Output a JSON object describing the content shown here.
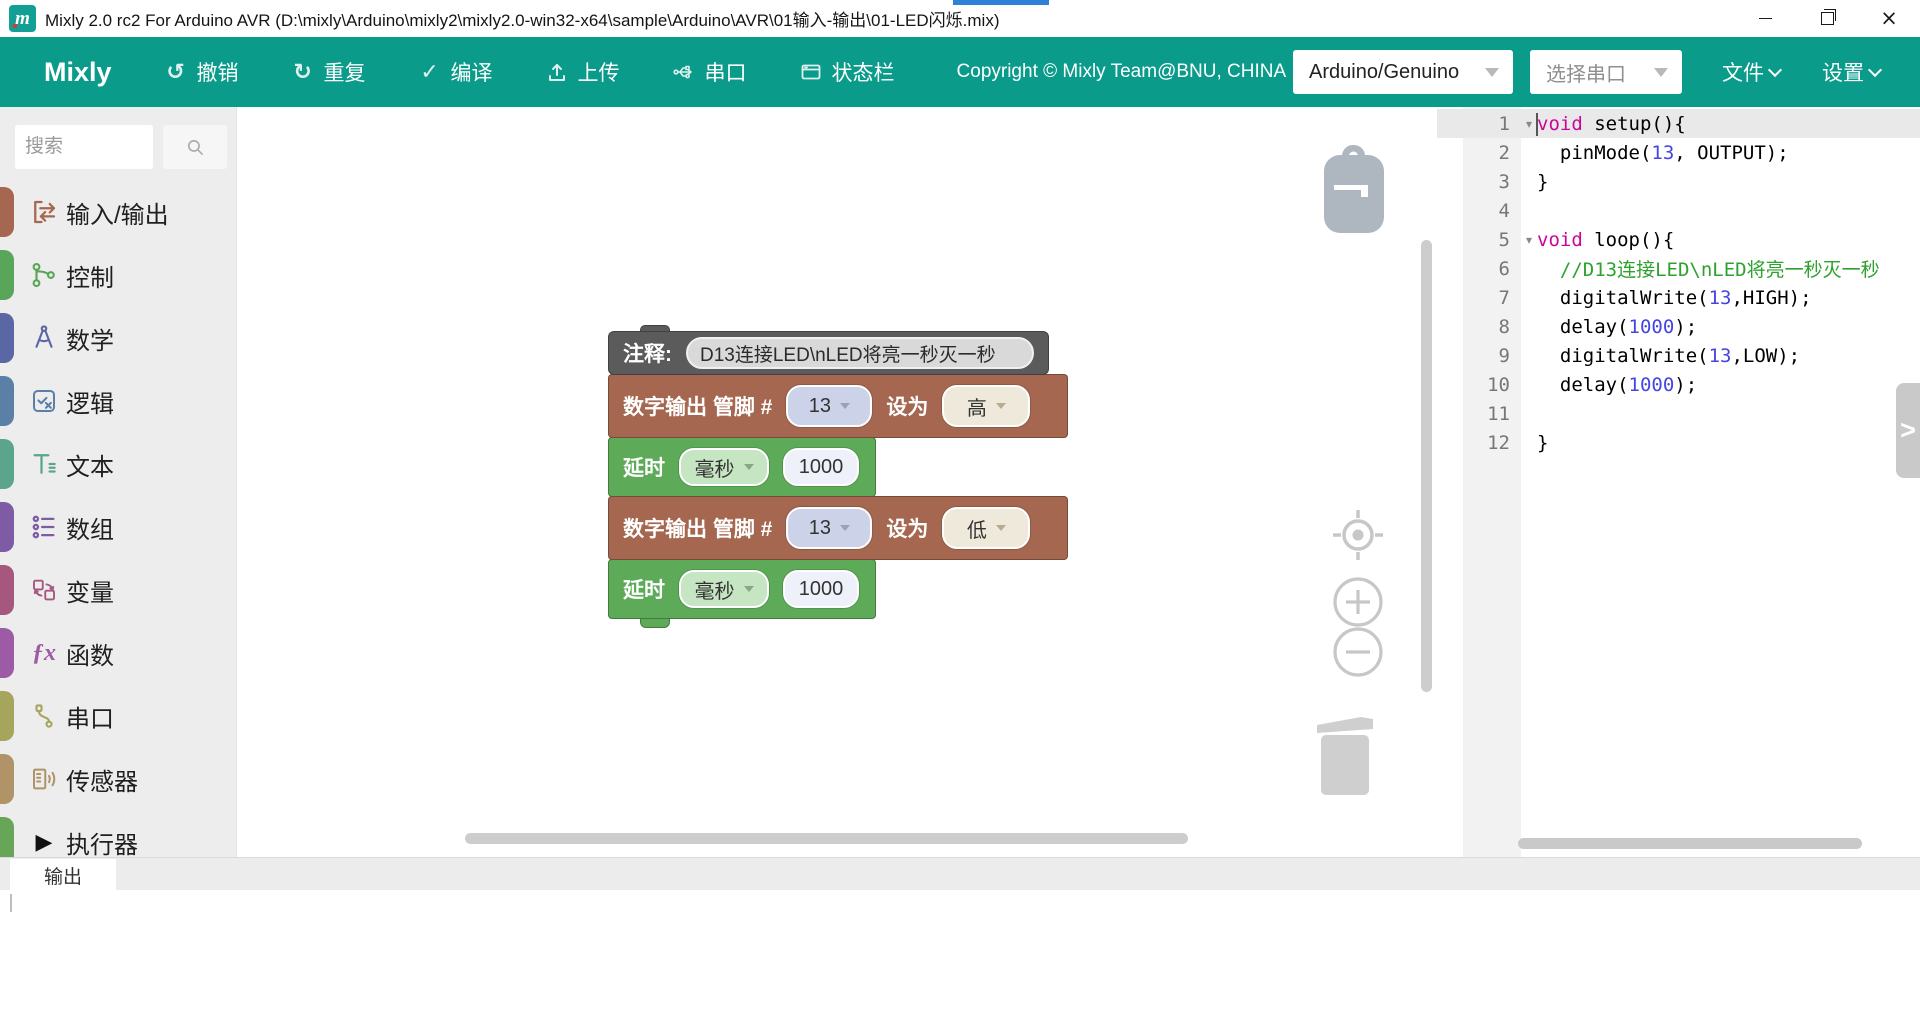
{
  "window": {
    "title": "Mixly 2.0 rc2 For Arduino AVR (D:\\mixly\\Arduino\\mixly2\\mixly2.0-win32-x64\\sample\\Arduino\\AVR\\01输入-输出\\01-LED闪烁.mix)",
    "logo_glyph": "m"
  },
  "toolbar": {
    "brand": "Mixly",
    "buttons": [
      {
        "key": "undo",
        "label": "撤销"
      },
      {
        "key": "redo",
        "label": "重复"
      },
      {
        "key": "compile",
        "label": "编译"
      },
      {
        "key": "upload",
        "label": "上传"
      },
      {
        "key": "serial",
        "label": "串口"
      },
      {
        "key": "statusbar",
        "label": "状态栏"
      }
    ],
    "copyright": "Copyright © Mixly Team@BNU, CHINA",
    "board_select": "Arduino/Genuino",
    "port_select": "选择串口",
    "menus": [
      {
        "key": "file",
        "label": "文件"
      },
      {
        "key": "settings",
        "label": "设置"
      }
    ]
  },
  "sidebar": {
    "search_placeholder": "搜索",
    "categories": [
      {
        "key": "io",
        "label": "输入/输出",
        "color": "#A5674F"
      },
      {
        "key": "control",
        "label": "控制",
        "color": "#59A559"
      },
      {
        "key": "math",
        "label": "数学",
        "color": "#5B67A5"
      },
      {
        "key": "logic",
        "label": "逻辑",
        "color": "#5B80A5"
      },
      {
        "key": "text",
        "label": "文本",
        "color": "#5BA58C"
      },
      {
        "key": "array",
        "label": "数组",
        "color": "#7D5BA5"
      },
      {
        "key": "variable",
        "label": "变量",
        "color": "#A5577D"
      },
      {
        "key": "function",
        "label": "函数",
        "color": "#9D5BA5"
      },
      {
        "key": "serial",
        "label": "串口",
        "color": "#A5A55B"
      },
      {
        "key": "sensor",
        "label": "传感器",
        "color": "#B09367"
      },
      {
        "key": "actuator",
        "label": "执行器",
        "color": "#67A557"
      }
    ]
  },
  "workspace": {
    "comment_block": {
      "label": "注释:",
      "text": "D13连接LED\\nLED将亮一秒灭一秒"
    },
    "digital_write_1": {
      "label_pin": "数字输出 管脚 #",
      "pin": "13",
      "label_set": "设为",
      "value": "高"
    },
    "delay_1": {
      "label": "延时",
      "unit": "毫秒",
      "ms": "1000"
    },
    "digital_write_2": {
      "label_pin": "数字输出 管脚 #",
      "pin": "13",
      "label_set": "设为",
      "value": "低"
    },
    "delay_2": {
      "label": "延时",
      "unit": "毫秒",
      "ms": "1000"
    }
  },
  "code": {
    "lines": [
      {
        "n": "1",
        "fold": true,
        "active": true,
        "segs": [
          {
            "c": "kw",
            "t": "void"
          },
          {
            "c": "ct",
            "t": " setup(){"
          }
        ]
      },
      {
        "n": "2",
        "segs": [
          {
            "c": "ct",
            "t": "  pinMode("
          },
          {
            "c": "num",
            "t": "13"
          },
          {
            "c": "ct",
            "t": ", OUTPUT);"
          }
        ]
      },
      {
        "n": "3",
        "segs": [
          {
            "c": "ct",
            "t": "}"
          }
        ]
      },
      {
        "n": "4",
        "segs": []
      },
      {
        "n": "5",
        "fold": true,
        "segs": [
          {
            "c": "kw",
            "t": "void"
          },
          {
            "c": "ct",
            "t": " loop(){"
          }
        ]
      },
      {
        "n": "6",
        "segs": [
          {
            "c": "cmt",
            "t": "  //D13连接LED\\nLED将亮一秒灭一秒"
          }
        ]
      },
      {
        "n": "7",
        "segs": [
          {
            "c": "ct",
            "t": "  digitalWrite("
          },
          {
            "c": "num",
            "t": "13"
          },
          {
            "c": "ct",
            "t": ",HIGH);"
          }
        ]
      },
      {
        "n": "8",
        "segs": [
          {
            "c": "ct",
            "t": "  delay("
          },
          {
            "c": "num",
            "t": "1000"
          },
          {
            "c": "ct",
            "t": ");"
          }
        ]
      },
      {
        "n": "9",
        "segs": [
          {
            "c": "ct",
            "t": "  digitalWrite("
          },
          {
            "c": "num",
            "t": "13"
          },
          {
            "c": "ct",
            "t": ",LOW);"
          }
        ]
      },
      {
        "n": "10",
        "segs": [
          {
            "c": "ct",
            "t": "  delay("
          },
          {
            "c": "num",
            "t": "1000"
          },
          {
            "c": "ct",
            "t": ");"
          }
        ]
      },
      {
        "n": "11",
        "segs": []
      },
      {
        "n": "12",
        "segs": [
          {
            "c": "ct",
            "t": "}"
          }
        ]
      }
    ]
  },
  "output": {
    "tab_label": "输出"
  },
  "colors": {
    "toolbar_teal": "#0A9B8B",
    "accent_blue": "#2E80D9",
    "keyword": "#CC0599",
    "number": "#4545E0",
    "comment": "#2EA22E"
  }
}
